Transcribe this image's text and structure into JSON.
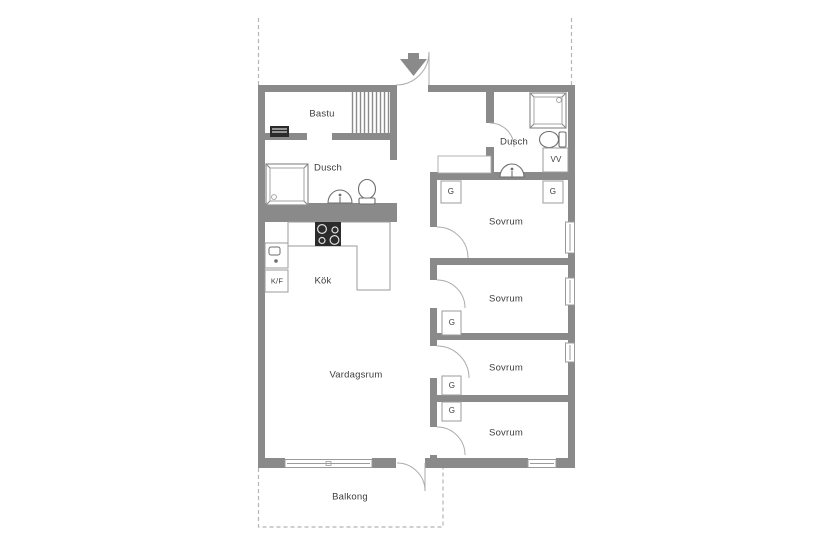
{
  "title": "Floor plan",
  "rooms": {
    "bastu": "Bastu",
    "dusch_left": "Dusch",
    "dusch_right": "Dusch",
    "kok": "Kök",
    "vardagsrum": "Vardagsrum",
    "sovrum_1": "Sovrum",
    "sovrum_2": "Sovrum",
    "sovrum_3": "Sovrum",
    "sovrum_4": "Sovrum",
    "balkong": "Balkong"
  },
  "boxes": {
    "kf": "K/F",
    "vv": "VV"
  },
  "closets": {
    "g1": "G",
    "g2": "G",
    "g3": "G",
    "g4": "G",
    "g5": "G"
  },
  "icons": {
    "entry_arrow_icon": "down-arrow marking entrance",
    "stove_icon": "4-burner stove",
    "sauna_heater_icon": "sauna heater",
    "sauna_benches_icon": "sauna bench slats",
    "shower_cabin_icon": "shower enclosure",
    "toilet_icon": "toilet",
    "sink_icon": "washbasin",
    "kitchen_sink_icon": "kitchen sink"
  },
  "colors": {
    "wall": "#8a8a8a",
    "outline": "#9b9b9b",
    "fixture": "#6e6e6e",
    "fixture_dark": "#2b2b2b",
    "dashed": "#b5b5b5",
    "text": "#3d3d3d",
    "background": "#ffffff"
  }
}
